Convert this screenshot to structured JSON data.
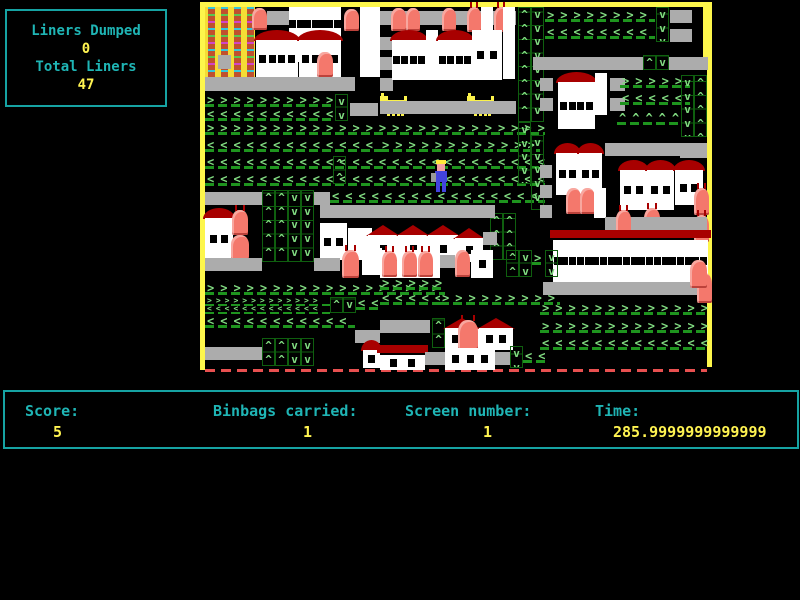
{
  "info_box": {
    "liners_dumped_label": "Liners Dumped",
    "liners_dumped_value": "0",
    "total_liners_label": "Total Liners",
    "total_liners_value": "47"
  },
  "status_bar": {
    "score_label": "Score:",
    "score_value": "5",
    "binbags_label": "Binbags carried:",
    "binbags_value": "1",
    "screen_label": "Screen number:",
    "screen_value": "1",
    "time_label": "Time:",
    "time_value": "285.9999999999999"
  },
  "colors": {
    "teal_text": "#1fb5b5",
    "yellow_text": "#fff351",
    "border_yellow": "#fdf64b",
    "chevron_green": "#82dc82",
    "separator_green": "#1e941e",
    "road_gray": "#acacac",
    "building_white": "#ffffff",
    "roof_dark_red": "#a80000",
    "binbag_salmon": "#f4786c",
    "dog_yellow": "#fbf24b",
    "player_blue": "#4343df",
    "bottom_dash_red": "#e85050"
  },
  "playfield": {
    "left": 200,
    "top": 2,
    "width": 512,
    "height": 371,
    "legend": {
      "road": "gray road segment [t,x,y,w,h]",
      "hR/hL/hU": "horizontal green chevron row right/left/up [t,x,y,w]",
      "hRs/hLs": "small chevron row [t,x,y,w]",
      "vU/vD": "boxed vertical chevron column up/down [t,x,y,w,h]",
      "bldg": "white building with windows, roof '' | dome | tri | flat [t,x,y,w,h,roof]",
      "col": "plain white column [t,x,y,w,h]",
      "bin": "red binbag, last flag = antennae [t,x,y,w,h,a]",
      "dog": "yellow dog sprite [t,x,y]",
      "tower": "yellow flats tower [t,x,y,w,h]",
      "player": "binman player sprite [t,x,y]"
    },
    "items": [
      [
        "tower",
        5,
        5,
        50,
        70
      ],
      [
        "road",
        18,
        53,
        13,
        14
      ],
      [
        "bin",
        52,
        6,
        15,
        22,
        0
      ],
      [
        "road",
        67,
        9,
        23,
        14
      ],
      [
        "bldg",
        89,
        5,
        52,
        55,
        ""
      ],
      [
        "bin",
        144,
        7,
        15,
        22,
        0
      ],
      [
        "col",
        160,
        5,
        20,
        70
      ],
      [
        "bldg",
        56,
        28,
        42,
        48,
        "dome"
      ],
      [
        "bldg",
        99,
        28,
        42,
        48,
        "dome"
      ],
      [
        "bin",
        117,
        50,
        16,
        25,
        0
      ],
      [
        "road",
        5,
        75,
        150,
        14
      ],
      [
        "road",
        180,
        9,
        136,
        14
      ],
      [
        "bin",
        191,
        6,
        15,
        23,
        0
      ],
      [
        "bin",
        206,
        6,
        14,
        23,
        0
      ],
      [
        "bin",
        242,
        6,
        14,
        23,
        0
      ],
      [
        "bin",
        267,
        5,
        14,
        25,
        1
      ],
      [
        "col",
        281,
        5,
        12,
        26
      ],
      [
        "bin",
        294,
        5,
        14,
        25,
        1
      ],
      [
        "road",
        180,
        35,
        13,
        13
      ],
      [
        "road",
        180,
        55,
        13,
        13
      ],
      [
        "road",
        180,
        76,
        13,
        13
      ],
      [
        "bldg",
        192,
        28,
        34,
        50,
        "dome"
      ],
      [
        "col",
        226,
        28,
        12,
        50
      ],
      [
        "bldg",
        238,
        28,
        34,
        50,
        "dome"
      ],
      [
        "bldg",
        272,
        28,
        30,
        50,
        ""
      ],
      [
        "col",
        303,
        5,
        12,
        72
      ],
      [
        "vU",
        318,
        5,
        13,
        115
      ],
      [
        "vD",
        331,
        5,
        13,
        115
      ],
      [
        "hR",
        345,
        7,
        110
      ],
      [
        "hL",
        345,
        24,
        110
      ],
      [
        "vD",
        456,
        5,
        13,
        35
      ],
      [
        "road",
        470,
        8,
        22,
        13
      ],
      [
        "road",
        470,
        27,
        22,
        13
      ],
      [
        "road",
        333,
        55,
        110,
        13
      ],
      [
        "vU",
        443,
        53,
        13,
        15
      ],
      [
        "vD",
        456,
        53,
        13,
        15
      ],
      [
        "road",
        469,
        55,
        39,
        13
      ],
      [
        "dog",
        180,
        91
      ],
      [
        "dog",
        267,
        91
      ],
      [
        "road",
        180,
        99,
        136,
        13
      ],
      [
        "hR",
        5,
        92,
        130
      ],
      [
        "hL",
        5,
        106,
        130
      ],
      [
        "vD",
        135,
        92,
        13,
        27
      ],
      [
        "road",
        150,
        101,
        28,
        13
      ],
      [
        "bldg",
        358,
        70,
        37,
        57,
        "dome"
      ],
      [
        "col",
        395,
        71,
        12,
        42
      ],
      [
        "road",
        340,
        76,
        13,
        13
      ],
      [
        "road",
        410,
        76,
        15,
        13
      ],
      [
        "road",
        340,
        96,
        13,
        13
      ],
      [
        "road",
        410,
        96,
        15,
        13
      ],
      [
        "hR",
        420,
        73,
        70
      ],
      [
        "hL",
        420,
        90,
        70
      ],
      [
        "hU",
        417,
        110,
        62
      ],
      [
        "vD",
        481,
        73,
        13,
        62
      ],
      [
        "vU",
        494,
        73,
        13,
        62
      ],
      [
        "road",
        480,
        143,
        27,
        13
      ],
      [
        "hR",
        5,
        120,
        340
      ],
      [
        "hL",
        5,
        137,
        175
      ],
      [
        "hR",
        180,
        137,
        160
      ],
      [
        "hL",
        5,
        154,
        340
      ],
      [
        "hL",
        5,
        171,
        340
      ],
      [
        "vU",
        133,
        154,
        13,
        28
      ],
      [
        "road",
        5,
        190,
        57,
        13
      ],
      [
        "vU",
        62,
        188,
        13,
        72
      ],
      [
        "vU",
        75,
        188,
        13,
        72
      ],
      [
        "vD",
        88,
        188,
        13,
        72
      ],
      [
        "vD",
        101,
        188,
        13,
        72
      ],
      [
        "road",
        114,
        190,
        16,
        13
      ],
      [
        "hL",
        130,
        188,
        215
      ],
      [
        "vD",
        318,
        120,
        13,
        62
      ],
      [
        "vD",
        331,
        133,
        13,
        75
      ],
      [
        "vU",
        290,
        211,
        13,
        47
      ],
      [
        "vU",
        303,
        211,
        13,
        47
      ],
      [
        "player",
        233,
        158
      ],
      [
        "road",
        120,
        203,
        175,
        13
      ],
      [
        "bldg",
        120,
        221,
        27,
        37,
        ""
      ],
      [
        "col",
        148,
        226,
        24,
        32
      ],
      [
        "bldg",
        168,
        223,
        30,
        37,
        "tri"
      ],
      [
        "bldg",
        198,
        223,
        30,
        37,
        "tri"
      ],
      [
        "bldg",
        228,
        223,
        30,
        37,
        "tri"
      ],
      [
        "bldg",
        255,
        226,
        28,
        34,
        "tri"
      ],
      [
        "road",
        283,
        230,
        14,
        13
      ],
      [
        "bldg",
        5,
        206,
        28,
        52,
        "dome"
      ],
      [
        "bin",
        32,
        208,
        16,
        25,
        1
      ],
      [
        "bin",
        31,
        233,
        18,
        25,
        0
      ],
      [
        "road",
        405,
        141,
        102,
        13
      ],
      [
        "bldg",
        356,
        141,
        23,
        52,
        "dome"
      ],
      [
        "bldg",
        379,
        141,
        23,
        52,
        "dome"
      ],
      [
        "bin",
        366,
        186,
        15,
        26,
        0
      ],
      [
        "bin",
        380,
        186,
        15,
        26,
        0
      ],
      [
        "col",
        394,
        186,
        12,
        30
      ],
      [
        "road",
        340,
        163,
        12,
        13
      ],
      [
        "road",
        340,
        183,
        12,
        13
      ],
      [
        "road",
        340,
        203,
        12,
        13
      ],
      [
        "bldg",
        420,
        158,
        27,
        50,
        "dome"
      ],
      [
        "bldg",
        447,
        158,
        27,
        50,
        "dome"
      ],
      [
        "bldg",
        475,
        158,
        28,
        45,
        "dome"
      ],
      [
        "bin",
        444,
        206,
        16,
        27,
        1
      ],
      [
        "bin",
        494,
        186,
        15,
        27,
        1
      ],
      [
        "bin",
        494,
        213,
        15,
        27,
        1
      ],
      [
        "road",
        405,
        215,
        102,
        13
      ],
      [
        "bin",
        416,
        208,
        15,
        25,
        1
      ],
      [
        "bldg",
        353,
        228,
        155,
        52,
        "flat"
      ],
      [
        "road",
        343,
        280,
        157,
        13
      ],
      [
        "bin",
        497,
        271,
        15,
        30,
        0
      ],
      [
        "hR",
        340,
        300,
        168
      ],
      [
        "hR",
        340,
        318,
        168
      ],
      [
        "hL",
        340,
        335,
        168
      ],
      [
        "road",
        5,
        256,
        57,
        13
      ],
      [
        "road",
        114,
        256,
        26,
        13
      ],
      [
        "bin",
        142,
        248,
        17,
        28,
        1
      ],
      [
        "col",
        162,
        246,
        20,
        27
      ],
      [
        "hR",
        5,
        280,
        240
      ],
      [
        "hRs",
        5,
        295,
        125
      ],
      [
        "hLs",
        5,
        303,
        125
      ],
      [
        "vU",
        130,
        295,
        13,
        16
      ],
      [
        "vD",
        143,
        295,
        13,
        16
      ],
      [
        "hL",
        156,
        295,
        24
      ],
      [
        "hL",
        180,
        290,
        60
      ],
      [
        "hR",
        240,
        290,
        120
      ],
      [
        "hL",
        5,
        313,
        150
      ],
      [
        "road",
        155,
        328,
        25,
        13
      ],
      [
        "road",
        5,
        345,
        57,
        13
      ],
      [
        "vU",
        62,
        336,
        13,
        28
      ],
      [
        "vU",
        75,
        336,
        13,
        28
      ],
      [
        "vD",
        88,
        336,
        13,
        28
      ],
      [
        "vD",
        101,
        336,
        13,
        28
      ],
      [
        "bldg",
        163,
        338,
        17,
        28,
        "dome"
      ],
      [
        "bldg",
        180,
        248,
        60,
        28,
        ""
      ],
      [
        "bin",
        182,
        249,
        15,
        26,
        1
      ],
      [
        "bin",
        202,
        249,
        15,
        26,
        1
      ],
      [
        "bin",
        218,
        249,
        15,
        26,
        1
      ],
      [
        "road",
        240,
        253,
        15,
        13
      ],
      [
        "bin",
        255,
        248,
        15,
        27,
        0
      ],
      [
        "bldg",
        271,
        248,
        22,
        28,
        ""
      ],
      [
        "vU",
        306,
        248,
        13,
        27
      ],
      [
        "vD",
        319,
        248,
        13,
        27
      ],
      [
        "hR",
        332,
        250,
        13
      ],
      [
        "vD",
        345,
        248,
        13,
        27
      ],
      [
        "hR",
        180,
        275,
        62
      ],
      [
        "road",
        180,
        318,
        50,
        13
      ],
      [
        "vU",
        232,
        316,
        13,
        30
      ],
      [
        "bldg",
        245,
        316,
        34,
        32,
        "tri"
      ],
      [
        "bin",
        258,
        318,
        20,
        30,
        1
      ],
      [
        "bldg",
        279,
        316,
        34,
        32,
        "tri"
      ],
      [
        "bldg",
        180,
        343,
        45,
        25,
        "flat"
      ],
      [
        "road",
        225,
        350,
        20,
        13
      ],
      [
        "bldg",
        245,
        346,
        50,
        22,
        ""
      ],
      [
        "road",
        295,
        350,
        15,
        13
      ],
      [
        "vD",
        310,
        344,
        13,
        22
      ],
      [
        "hL",
        323,
        348,
        25
      ],
      [
        "bin",
        490,
        258,
        17,
        28,
        0
      ]
    ]
  }
}
